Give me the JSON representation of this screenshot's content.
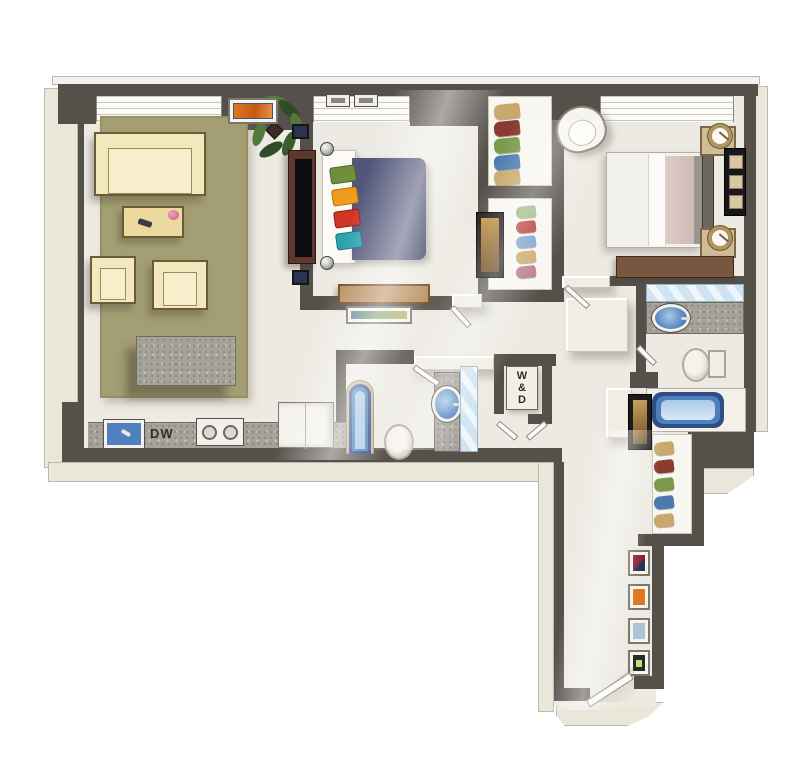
{
  "labels": {
    "dishwasher": "DW",
    "washer_dryer": "W\n&\nD"
  },
  "palette": {
    "wall": "#56504a",
    "wall_outer_face": "#e9e6da",
    "floor": "#edeae3",
    "rug_olive": "#a49e74",
    "sofa_cream": "#f2e7bd",
    "wood_dark": "#5c392c",
    "wood_bench": "#b98a58",
    "granite": "#a5a29a",
    "sink_blue": "#4f7fbe",
    "duvet_navy": "#4b4f74",
    "pillow_green": "#6f8f3e",
    "pillow_orange": "#f09a1e",
    "pillow_red": "#d23426",
    "pillow_teal": "#2aa3ad",
    "mirror_blue": "#cfe3f3",
    "tub_rim_navy": "#2e4f86",
    "art_orange": "#e07820",
    "plant_green": "#3c5c31"
  },
  "objects": [
    "area-rug",
    "sofa",
    "coffee-table",
    "armchair",
    "kitchen-island",
    "potted-plant",
    "console-art",
    "tv-console",
    "flat-screen-tv",
    "kitchen-counter",
    "kitchen-sink",
    "dishwasher",
    "cooktop",
    "refrigerator",
    "double-bed-navy",
    "bench",
    "ceiling-vents",
    "wardrobe-shelves",
    "wall-art",
    "double-bed-white",
    "round-armchair",
    "nightstand",
    "table-lamp",
    "bedroom-dresser",
    "bathroom-vanity",
    "vanity-sink",
    "bathroom-mirror",
    "toilet",
    "bathtub",
    "washer-dryer-closet",
    "linen-closet",
    "gallery-frames",
    "entry-door"
  ]
}
